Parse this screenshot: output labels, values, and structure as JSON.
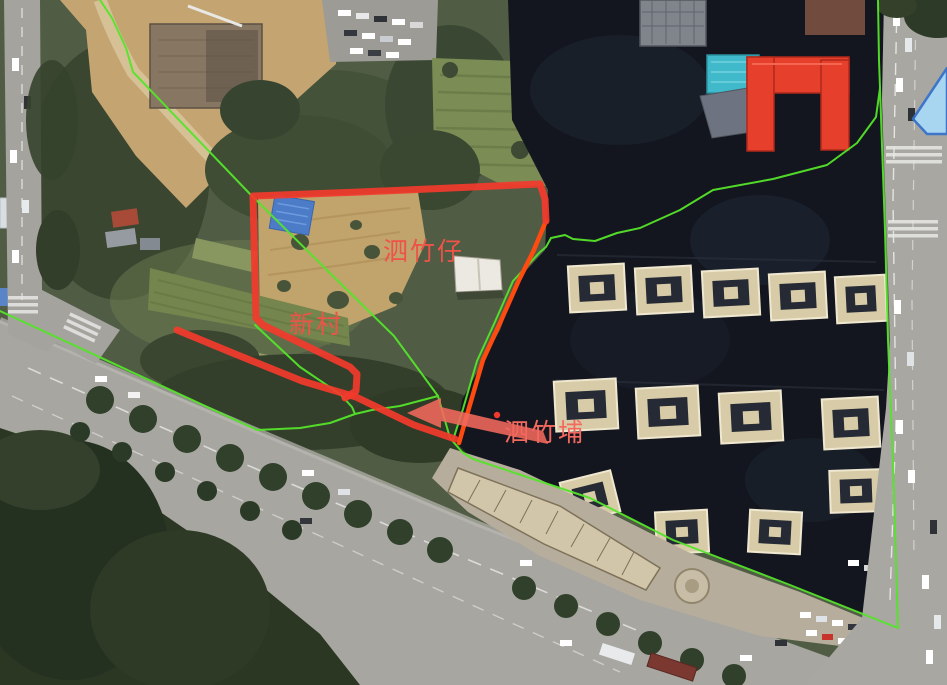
{
  "map": {
    "kind": "satellite-imagery-with-annotations",
    "place_labels": [
      {
        "id": "sizhuzai",
        "text": "泗竹仔"
      },
      {
        "id": "xincun",
        "text": "新村"
      },
      {
        "id": "sizhupu",
        "text": "泗竹埔"
      }
    ],
    "overlay_colors": {
      "boundary-green": "#55e42a",
      "highlight-red": "#f23a2c",
      "edge-orange": "#ff4a10",
      "marker-salmon": "#f3695d",
      "label-red": "#ee5347",
      "dot-red": "#ee392c",
      "selection-blue-fill": "#a9d9f6",
      "selection-blue-stroke": "#3572cc"
    }
  }
}
